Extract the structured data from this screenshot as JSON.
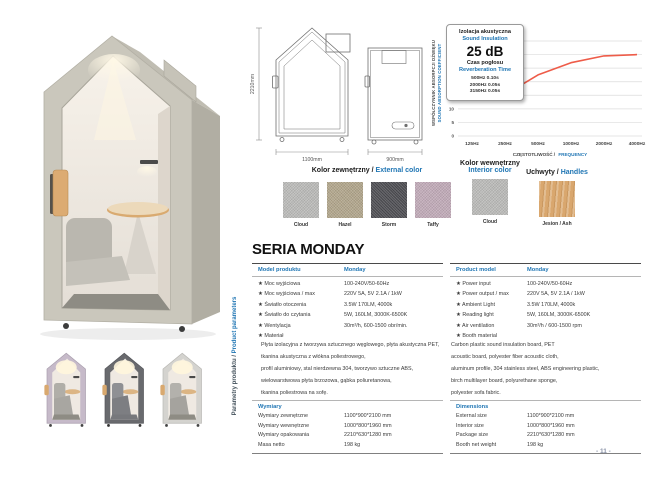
{
  "page_number": "- 11 -",
  "series_title": "SERIA MONDAY",
  "sidebar": {
    "label_pl": "Parametry produktu /",
    "label_en": "Product parameters"
  },
  "drawings": {
    "height": "2210mm",
    "width_front": "1100mm",
    "width_side": "900mm"
  },
  "info_box": {
    "title_pl": "Izolacja akustyczna",
    "title_en": "Sound Insulation",
    "value": "25 dB",
    "subtitle_pl": "Czas pogłosu",
    "subtitle_en": "Reverberation Time",
    "rows": [
      "500Hz 0.10s",
      "2000Hz 0.05s",
      "3150Hz 0.05s"
    ]
  },
  "chart_data": {
    "type": "line",
    "x_categories": [
      "125Hz",
      "250Hz",
      "500Hz",
      "1000Hz",
      "2000Hz",
      "4000Hz"
    ],
    "values": [
      15.8,
      15.2,
      22.5,
      27,
      29.5,
      30
    ],
    "yticks": [
      0,
      5,
      10,
      15,
      20,
      25,
      30,
      35
    ],
    "ylim": [
      0,
      35
    ],
    "ylabel_pl": "WSPÓŁCZYNNIK ABSORPCJI DŹWIĘKU",
    "ylabel_en": "SOUND ABSORPTION COEFFICIENT",
    "xlabel_pl": "CZĘSTOTLIWOŚĆ /",
    "xlabel_en": "FREQUENCY",
    "line_color": "#ee5c49",
    "grid": true,
    "legend": "none"
  },
  "swatches": {
    "external": {
      "title_pl": "Kolor zewnętrzny /",
      "title_en": "External color",
      "items": [
        {
          "name": "Cloud",
          "color": "#bcbcba"
        },
        {
          "name": "Hazel",
          "color": "#b2a68b"
        },
        {
          "name": "Storm",
          "color": "#4c4c51"
        },
        {
          "name": "Taffy",
          "color": "#c2abb9"
        }
      ]
    },
    "interior": {
      "title_pl": "Kolor wewnętrzny",
      "title_en": "Interior color",
      "items": [
        {
          "name": "Cloud",
          "color": "#bcbcba"
        }
      ]
    },
    "handles": {
      "title_pl": "Uchwyty /",
      "title_en": "Handles",
      "items": [
        {
          "name": "Jesion / Ash",
          "color": "#d9a76e"
        }
      ]
    }
  },
  "tables": {
    "left": {
      "header_label": "Model produktu",
      "header_value": "Monday",
      "rows": [
        {
          "label": "★ Moc wyjściowa",
          "value": "100-240V/50-60Hz"
        },
        {
          "label": "★ Moc wyjściowa / max",
          "value": "220V 5A, 5V 2.1A / 1kW"
        },
        {
          "label": "★ Światło otoczenia",
          "value": "3.5W 170LM, 4000k"
        },
        {
          "label": "★ Światło do czytania",
          "value": "5W, 160LM, 3000K-6500K"
        },
        {
          "label": "★ Wentylacja",
          "value": "30m³/h, 600-1500 obr/min."
        },
        {
          "label": "★ Materiał",
          "value": ""
        }
      ],
      "material_lines": [
        "Płyta izolacyjna z tworzywa sztucznego węglowego, płyta akustyczna PET,",
        "tkanina akustyczna z włókna poliestrowego,",
        "profil aluminiowy, stal nierdzewna 304, tworzywo sztuczne ABS,",
        "wielowarstwowa płyta brzozowa, gąbka poliuretanowa,",
        "tkanina poliestrowa na sofę."
      ],
      "dims_header": "Wymiary",
      "dims": [
        {
          "label": "Wymiary zewnętrzne",
          "value": "1100*900*2100 mm"
        },
        {
          "label": "Wymiary wewnętrzne",
          "value": "1000*800*1960 mm"
        },
        {
          "label": "Wymiary opakowania",
          "value": "2210*630*1280 mm"
        },
        {
          "label": "Masa netto",
          "value": "198 kg"
        }
      ]
    },
    "right": {
      "header_label": "Product model",
      "header_value": "Monday",
      "rows": [
        {
          "label": "★ Power input",
          "value": "100-240V/50-60Hz"
        },
        {
          "label": "★ Power output / max",
          "value": "220V 5A, 5V 2.1A / 1kW"
        },
        {
          "label": "★ Ambient Light",
          "value": "3.5W 170LM, 4000k"
        },
        {
          "label": "★ Reading light",
          "value": "5W, 160LM, 3000K-6500K"
        },
        {
          "label": "★ Air ventilation",
          "value": "30m³/h / 600-1500 rpm"
        },
        {
          "label": "★ Booth material",
          "value": ""
        }
      ],
      "material_lines": [
        "Carbon plastic sound insulation board, PET",
        "acoustic board, polyester fiber acoustic cloth,",
        "aluminum profile, 304 stainless steel, ABS engineering plastic,",
        "birch multilayer board, polyurethane sponge,",
        "polyester sofa fabric."
      ],
      "dims_header": "Dimensions",
      "dims": [
        {
          "label": "External size",
          "value": "1100*900*2100 mm"
        },
        {
          "label": "Interior size",
          "value": "1000*800*1960 mm"
        },
        {
          "label": "Package size",
          "value": "2210*630*1280 mm"
        },
        {
          "label": "Booth net weight",
          "value": "198 kg"
        }
      ]
    }
  },
  "accent": {
    "blue": "#2076b4",
    "red_line": "#ee5c49"
  }
}
